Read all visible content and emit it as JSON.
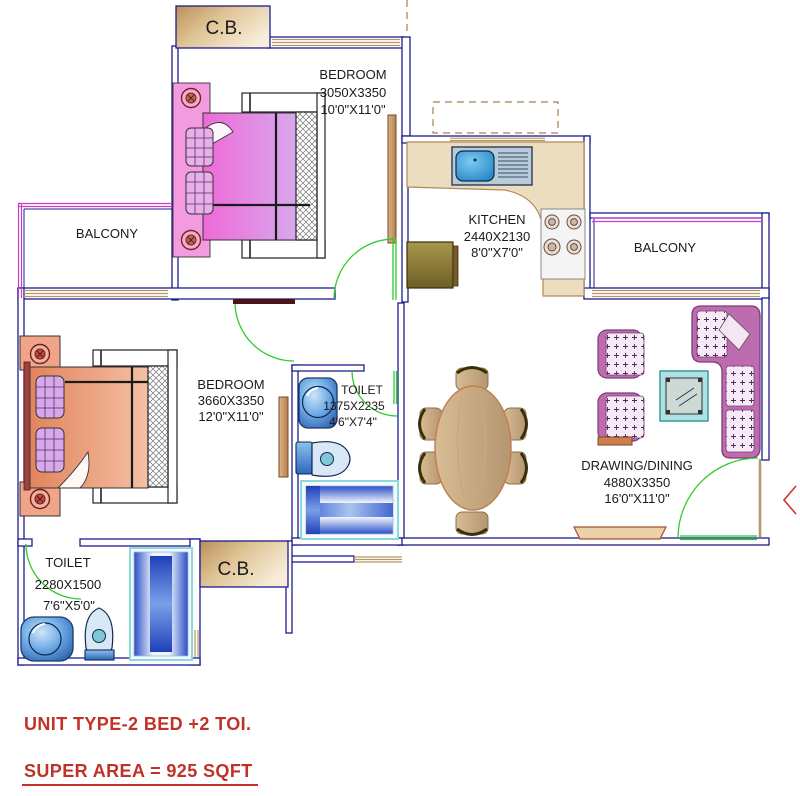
{
  "plan": {
    "rooms": {
      "bedroom_top": {
        "label": "BEDROOM",
        "size_mm": "3050X3350",
        "size_ft": "10'0\"X11'0\""
      },
      "bedroom_left": {
        "label": "BEDROOM",
        "size_mm": "3660X3350",
        "size_ft": "12'0\"X11'0\""
      },
      "kitchen": {
        "label": "KITCHEN",
        "size_mm": "2440X2130",
        "size_ft": "8'0\"X7'0\""
      },
      "toilet_middle": {
        "label": "TOILET",
        "size_mm": "1375X2235",
        "size_ft": "4'6\"X7'4\""
      },
      "toilet_bottom": {
        "label": "TOILET",
        "size_mm": "2280X1500",
        "size_ft": "7'6\"X5'0\""
      },
      "drawing_dining": {
        "label": "DRAWING/DINING",
        "size_mm": "4880X3350",
        "size_ft": "16'0\"X11'0\""
      },
      "balcony_left": {
        "label": "BALCONY"
      },
      "balcony_right": {
        "label": "BALCONY"
      },
      "cupboard_top": {
        "label": "C.B."
      },
      "cupboard_bottom": {
        "label": "C.B."
      }
    },
    "colors": {
      "wall": "#1c1c90",
      "window_frame": "#b89868",
      "door": "#2ecc2e",
      "railing": "#cc3ccc",
      "annotation_red": "#c03228"
    }
  },
  "footer": {
    "unit_type": "UNIT TYPE-2 BED +2 TOI.",
    "super_area": "SUPER AREA = 925 SQFT"
  }
}
